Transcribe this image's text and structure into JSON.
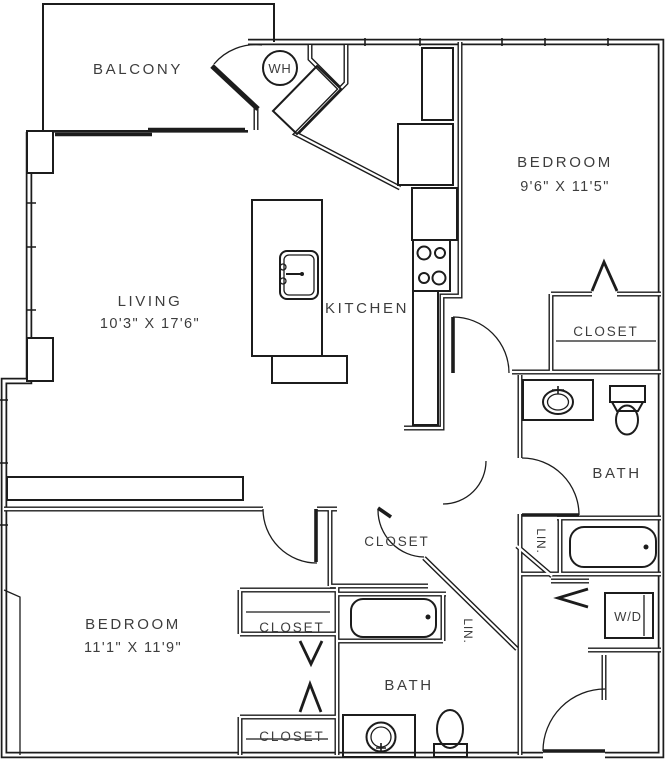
{
  "floorplan": {
    "colors": {
      "background": "#ffffff",
      "walls": "#1c1c1c",
      "text": "#3d3d3d"
    },
    "rooms": {
      "balcony": {
        "label": "BALCONY"
      },
      "living": {
        "label": "LIVING",
        "dimensions": "10'3\" X 17'6\""
      },
      "kitchen": {
        "label": "KITCHEN"
      },
      "bedroom1": {
        "label": "BEDROOM",
        "dimensions": "9'6\" X 11'5\""
      },
      "bedroom2": {
        "label": "BEDROOM",
        "dimensions": "11'1\" X 11'9\""
      },
      "bath1": {
        "label": "BATH"
      },
      "bath2": {
        "label": "BATH"
      }
    },
    "closets": {
      "bedroom1_closet": {
        "label": "CLOSET"
      },
      "hall_closet": {
        "label": "CLOSET"
      },
      "bedroom2_closet_a": {
        "label": "CLOSET"
      },
      "bedroom2_closet_b": {
        "label": "CLOSET"
      },
      "linen1": {
        "label": "LIN."
      },
      "linen2": {
        "label": "LIN."
      }
    },
    "utilities": {
      "water_heater": {
        "label": "WH"
      },
      "washer_dryer": {
        "label": "W/D"
      }
    }
  }
}
